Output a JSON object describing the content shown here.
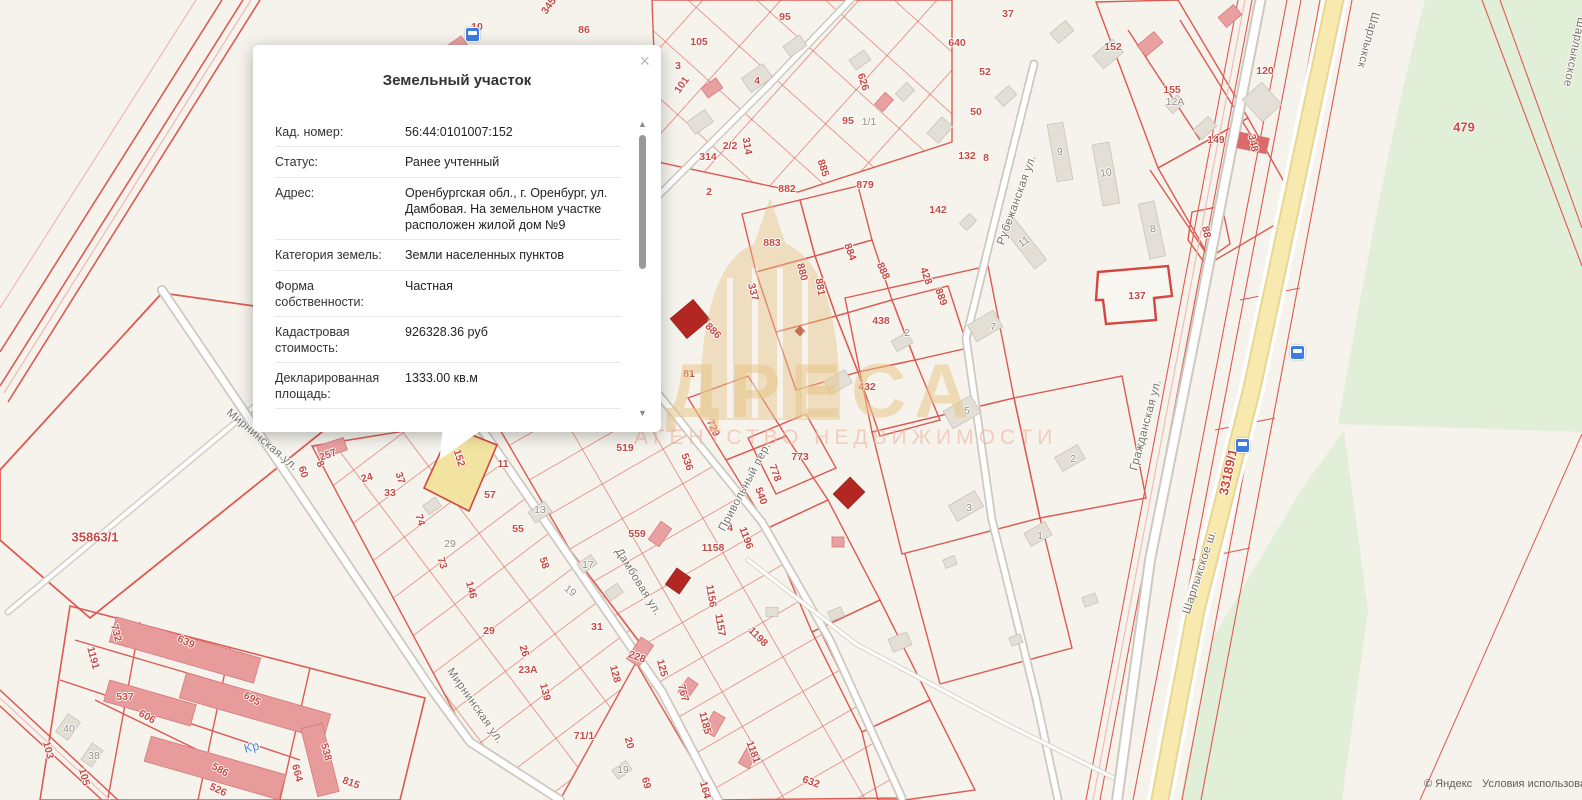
{
  "popup": {
    "title": "Земельный участок",
    "close_glyph": "×",
    "rows": [
      {
        "label": "Кад. номер:",
        "value": "56:44:0101007:152"
      },
      {
        "label": "Статус:",
        "value": "Ранее учтенный"
      },
      {
        "label": "Адрес:",
        "value": "Оренбургская обл., г. Оренбург, ул. Дамбовая. На земельном участке расположен жилой дом №9"
      },
      {
        "label": "Категория земель:",
        "value": "Земли населенных пунктов"
      },
      {
        "label": "Форма собственности:",
        "value": "Частная"
      },
      {
        "label": "Кадастровая стоимость:",
        "value": "926328.36 руб"
      },
      {
        "label": "Декларированная площадь:",
        "value": "1333.00 кв.м"
      }
    ],
    "scroll_up_glyph": "▲",
    "scroll_down_glyph": "▼"
  },
  "watermark": {
    "title": "АДРЕСА",
    "subtitle": "АГЕНТСТВО НЕДВИЖИМОСТИ"
  },
  "attribution": {
    "copyright": "© Яндекс",
    "terms": "Условия использования"
  },
  "colors": {
    "map_bg": "#f5f3ec",
    "parcel_line": "#dd5a52",
    "selected_fill": "#f2e3a0",
    "road_yellow": "#f8e9ae",
    "green_area": "#e2efd8",
    "bus_blue": "#3f7be0",
    "watermark_gold": "#e7c488",
    "dark_building": "#b32723",
    "pink_building": "#e9a0a0"
  },
  "map": {
    "selected_parcel": "152",
    "labels": [
      {
        "t": "345",
        "x": 549,
        "y": 6,
        "r": -55,
        "k": "parcel"
      },
      {
        "t": "86",
        "x": 584,
        "y": 30,
        "r": 0,
        "k": "parcel"
      },
      {
        "t": "10",
        "x": 477,
        "y": 27,
        "r": 0,
        "k": "parcel"
      },
      {
        "t": "105",
        "x": 699,
        "y": 42,
        "r": 0,
        "k": "parcel"
      },
      {
        "t": "3",
        "x": 678,
        "y": 66,
        "r": 0,
        "k": "parcel"
      },
      {
        "t": "101",
        "x": 682,
        "y": 85,
        "r": -55,
        "k": "parcel"
      },
      {
        "t": "4",
        "x": 757,
        "y": 81,
        "r": 0,
        "k": "parcel"
      },
      {
        "t": "95",
        "x": 785,
        "y": 17,
        "r": 0,
        "k": "parcel"
      },
      {
        "t": "626",
        "x": 863,
        "y": 82,
        "r": 72,
        "k": "parcel"
      },
      {
        "t": "640",
        "x": 957,
        "y": 43,
        "r": 0,
        "k": "parcel"
      },
      {
        "t": "37",
        "x": 1008,
        "y": 14,
        "r": 0,
        "k": "parcel"
      },
      {
        "t": "52",
        "x": 985,
        "y": 72,
        "r": 0,
        "k": "parcel"
      },
      {
        "t": "50",
        "x": 976,
        "y": 112,
        "r": 0,
        "k": "parcel"
      },
      {
        "t": "132",
        "x": 967,
        "y": 156,
        "r": 0,
        "k": "parcel"
      },
      {
        "t": "8",
        "x": 986,
        "y": 158,
        "r": 0,
        "k": "parcel"
      },
      {
        "t": "2/2",
        "x": 730,
        "y": 146,
        "r": 0,
        "k": "parcel"
      },
      {
        "t": "314",
        "x": 708,
        "y": 157,
        "r": 0,
        "k": "parcel"
      },
      {
        "t": "314",
        "x": 747,
        "y": 146,
        "r": 80,
        "k": "parcel"
      },
      {
        "t": "2",
        "x": 709,
        "y": 192,
        "r": 0,
        "k": "parcel"
      },
      {
        "t": "95",
        "x": 848,
        "y": 121,
        "r": 0,
        "k": "parcel"
      },
      {
        "t": "882",
        "x": 787,
        "y": 189,
        "r": 0,
        "k": "parcel"
      },
      {
        "t": "885",
        "x": 823,
        "y": 168,
        "r": 72,
        "k": "parcel"
      },
      {
        "t": "879",
        "x": 865,
        "y": 185,
        "r": 0,
        "k": "parcel"
      },
      {
        "t": "883",
        "x": 772,
        "y": 243,
        "r": 0,
        "k": "parcel"
      },
      {
        "t": "880",
        "x": 802,
        "y": 272,
        "r": 75,
        "k": "parcel"
      },
      {
        "t": "881",
        "x": 820,
        "y": 287,
        "r": 80,
        "k": "parcel"
      },
      {
        "t": "884",
        "x": 850,
        "y": 252,
        "r": 70,
        "k": "parcel"
      },
      {
        "t": "888",
        "x": 883,
        "y": 271,
        "r": 65,
        "k": "parcel"
      },
      {
        "t": "428",
        "x": 926,
        "y": 276,
        "r": 70,
        "k": "parcel"
      },
      {
        "t": "889",
        "x": 941,
        "y": 297,
        "r": 70,
        "k": "parcel"
      },
      {
        "t": "337",
        "x": 753,
        "y": 292,
        "r": 75,
        "k": "parcel"
      },
      {
        "t": "886",
        "x": 713,
        "y": 331,
        "r": 45,
        "k": "parcel"
      },
      {
        "t": "438",
        "x": 881,
        "y": 321,
        "r": 0,
        "k": "parcel"
      },
      {
        "t": "142",
        "x": 938,
        "y": 210,
        "r": 0,
        "k": "parcel"
      },
      {
        "t": "81",
        "x": 689,
        "y": 374,
        "r": 0,
        "k": "parcel"
      },
      {
        "t": "432",
        "x": 867,
        "y": 387,
        "r": 0,
        "k": "parcel"
      },
      {
        "t": "152",
        "x": 1113,
        "y": 47,
        "r": 0,
        "k": "parcel"
      },
      {
        "t": "155",
        "x": 1172,
        "y": 90,
        "r": 0,
        "k": "parcel"
      },
      {
        "t": "149",
        "x": 1216,
        "y": 140,
        "r": 0,
        "k": "parcel"
      },
      {
        "t": "120",
        "x": 1265,
        "y": 71,
        "r": 0,
        "k": "parcel"
      },
      {
        "t": "348",
        "x": 1253,
        "y": 143,
        "r": 78,
        "k": "parcel"
      },
      {
        "t": "88",
        "x": 1206,
        "y": 232,
        "r": 78,
        "k": "parcel"
      },
      {
        "t": "137",
        "x": 1137,
        "y": 296,
        "r": 0,
        "k": "parcel"
      },
      {
        "t": "60",
        "x": 303,
        "y": 472,
        "r": 72,
        "k": "parcel"
      },
      {
        "t": "257",
        "x": 328,
        "y": 455,
        "r": -20,
        "k": "parcel"
      },
      {
        "t": "24",
        "x": 367,
        "y": 478,
        "r": -15,
        "k": "parcel"
      },
      {
        "t": "33",
        "x": 390,
        "y": 493,
        "r": 0,
        "k": "parcel"
      },
      {
        "t": "37",
        "x": 400,
        "y": 478,
        "r": 72,
        "k": "parcel"
      },
      {
        "t": "74",
        "x": 420,
        "y": 520,
        "r": 72,
        "k": "parcel"
      },
      {
        "t": "73",
        "x": 442,
        "y": 563,
        "r": 72,
        "k": "parcel"
      },
      {
        "t": "146",
        "x": 471,
        "y": 590,
        "r": 75,
        "k": "parcel"
      },
      {
        "t": "29",
        "x": 489,
        "y": 631,
        "r": 0,
        "k": "parcel"
      },
      {
        "t": "26",
        "x": 524,
        "y": 651,
        "r": 72,
        "k": "parcel"
      },
      {
        "t": "23А",
        "x": 528,
        "y": 670,
        "r": 0,
        "k": "parcel"
      },
      {
        "t": "139",
        "x": 545,
        "y": 692,
        "r": 75,
        "k": "parcel"
      },
      {
        "t": "8",
        "x": 320,
        "y": 464,
        "r": 60,
        "k": "parcel"
      },
      {
        "t": "152",
        "x": 459,
        "y": 458,
        "r": 72,
        "k": "parcel"
      },
      {
        "t": "11",
        "x": 503,
        "y": 464,
        "r": 0,
        "k": "parcel"
      },
      {
        "t": "57",
        "x": 490,
        "y": 495,
        "r": 0,
        "k": "parcel"
      },
      {
        "t": "55",
        "x": 518,
        "y": 529,
        "r": 0,
        "k": "parcel"
      },
      {
        "t": "58",
        "x": 544,
        "y": 563,
        "r": 72,
        "k": "parcel"
      },
      {
        "t": "31",
        "x": 597,
        "y": 627,
        "r": 0,
        "k": "parcel"
      },
      {
        "t": "519",
        "x": 625,
        "y": 448,
        "r": 0,
        "k": "parcel"
      },
      {
        "t": "536",
        "x": 687,
        "y": 462,
        "r": 70,
        "k": "parcel"
      },
      {
        "t": "729",
        "x": 713,
        "y": 428,
        "r": 65,
        "k": "parcel"
      },
      {
        "t": "559",
        "x": 637,
        "y": 534,
        "r": 0,
        "k": "parcel"
      },
      {
        "t": "540",
        "x": 761,
        "y": 496,
        "r": 70,
        "k": "parcel"
      },
      {
        "t": "1196",
        "x": 746,
        "y": 538,
        "r": 70,
        "k": "parcel"
      },
      {
        "t": "1158",
        "x": 713,
        "y": 548,
        "r": 0,
        "k": "parcel"
      },
      {
        "t": "1156",
        "x": 711,
        "y": 596,
        "r": 80,
        "k": "parcel"
      },
      {
        "t": "1157",
        "x": 720,
        "y": 625,
        "r": 80,
        "k": "parcel"
      },
      {
        "t": "1198",
        "x": 758,
        "y": 637,
        "r": 45,
        "k": "parcel"
      },
      {
        "t": "778",
        "x": 775,
        "y": 473,
        "r": 70,
        "k": "parcel"
      },
      {
        "t": "773",
        "x": 800,
        "y": 457,
        "r": 0,
        "k": "parcel"
      },
      {
        "t": "228",
        "x": 637,
        "y": 657,
        "r": 20,
        "k": "parcel"
      },
      {
        "t": "128",
        "x": 615,
        "y": 674,
        "r": 75,
        "k": "parcel"
      },
      {
        "t": "125",
        "x": 662,
        "y": 668,
        "r": 75,
        "k": "parcel"
      },
      {
        "t": "767",
        "x": 683,
        "y": 693,
        "r": 75,
        "k": "parcel"
      },
      {
        "t": "71/1",
        "x": 584,
        "y": 736,
        "r": 0,
        "k": "parcel"
      },
      {
        "t": "20",
        "x": 629,
        "y": 743,
        "r": 75,
        "k": "parcel"
      },
      {
        "t": "69",
        "x": 646,
        "y": 783,
        "r": 75,
        "k": "parcel"
      },
      {
        "t": "1185",
        "x": 705,
        "y": 723,
        "r": 75,
        "k": "parcel"
      },
      {
        "t": "1181",
        "x": 753,
        "y": 752,
        "r": 70,
        "k": "parcel"
      },
      {
        "t": "164",
        "x": 705,
        "y": 790,
        "r": 75,
        "k": "parcel"
      },
      {
        "t": "632",
        "x": 811,
        "y": 782,
        "r": 20,
        "k": "parcel"
      },
      {
        "t": "4",
        "x": 730,
        "y": 528,
        "r": 0,
        "k": "parcel"
      },
      {
        "t": "1191",
        "x": 93,
        "y": 658,
        "r": 75,
        "k": "parcel"
      },
      {
        "t": "732",
        "x": 116,
        "y": 633,
        "r": 75,
        "k": "parcel"
      },
      {
        "t": "639",
        "x": 186,
        "y": 642,
        "r": 25,
        "k": "parcel"
      },
      {
        "t": "537",
        "x": 125,
        "y": 697,
        "r": 0,
        "k": "parcel"
      },
      {
        "t": "606",
        "x": 147,
        "y": 717,
        "r": 30,
        "k": "parcel"
      },
      {
        "t": "695",
        "x": 252,
        "y": 699,
        "r": 30,
        "k": "parcel"
      },
      {
        "t": "103",
        "x": 48,
        "y": 750,
        "r": 75,
        "k": "parcel"
      },
      {
        "t": "105",
        "x": 84,
        "y": 777,
        "r": 75,
        "k": "parcel"
      },
      {
        "t": "586",
        "x": 220,
        "y": 770,
        "r": 30,
        "k": "parcel"
      },
      {
        "t": "538",
        "x": 326,
        "y": 752,
        "r": 75,
        "k": "parcel"
      },
      {
        "t": "815",
        "x": 351,
        "y": 783,
        "r": 20,
        "k": "parcel"
      },
      {
        "t": "664",
        "x": 297,
        "y": 773,
        "r": 75,
        "k": "parcel"
      },
      {
        "t": "526",
        "x": 218,
        "y": 790,
        "r": 25,
        "k": "parcel"
      },
      {
        "t": "479",
        "x": 1464,
        "y": 127,
        "r": 0,
        "k": "parcel-big"
      },
      {
        "t": "33189/1",
        "x": 1228,
        "y": 472,
        "r": -78,
        "k": "parcel-big"
      },
      {
        "t": "35863/1",
        "x": 95,
        "y": 537,
        "r": 0,
        "k": "parcel-big"
      },
      {
        "t": "1/1",
        "x": 869,
        "y": 122,
        "r": 0,
        "k": "house"
      },
      {
        "t": "2",
        "x": 907,
        "y": 333,
        "r": 0,
        "k": "house"
      },
      {
        "t": "9",
        "x": 1060,
        "y": 152,
        "r": -8,
        "k": "house"
      },
      {
        "t": "10",
        "x": 1106,
        "y": 173,
        "r": -8,
        "k": "house"
      },
      {
        "t": "8",
        "x": 1153,
        "y": 229,
        "r": -10,
        "k": "house"
      },
      {
        "t": "11",
        "x": 1024,
        "y": 242,
        "r": -35,
        "k": "house"
      },
      {
        "t": "12А",
        "x": 1175,
        "y": 102,
        "r": 0,
        "k": "house"
      },
      {
        "t": "7",
        "x": 993,
        "y": 327,
        "r": 0,
        "k": "house"
      },
      {
        "t": "5",
        "x": 967,
        "y": 411,
        "r": 0,
        "k": "house"
      },
      {
        "t": "2",
        "x": 1073,
        "y": 459,
        "r": 0,
        "k": "house"
      },
      {
        "t": "3",
        "x": 969,
        "y": 508,
        "r": 0,
        "k": "house"
      },
      {
        "t": "1",
        "x": 1040,
        "y": 536,
        "r": 0,
        "k": "house"
      },
      {
        "t": "13",
        "x": 540,
        "y": 510,
        "r": 0,
        "k": "house"
      },
      {
        "t": "17",
        "x": 588,
        "y": 565,
        "r": 0,
        "k": "house"
      },
      {
        "t": "19",
        "x": 570,
        "y": 591,
        "r": 40,
        "k": "house"
      },
      {
        "t": "19",
        "x": 623,
        "y": 770,
        "r": 0,
        "k": "house"
      },
      {
        "t": "29",
        "x": 450,
        "y": 544,
        "r": 0,
        "k": "house"
      },
      {
        "t": "40",
        "x": 69,
        "y": 729,
        "r": 0,
        "k": "house"
      },
      {
        "t": "38",
        "x": 94,
        "y": 756,
        "r": 0,
        "k": "house"
      },
      {
        "t": "Мирнинская ул.",
        "x": 262,
        "y": 440,
        "r": 40,
        "k": "street"
      },
      {
        "t": "Мирнинская ул.",
        "x": 475,
        "y": 706,
        "r": 55,
        "k": "street"
      },
      {
        "t": "Дамбовая ул.",
        "x": 638,
        "y": 582,
        "r": 58,
        "k": "street"
      },
      {
        "t": "Привольный пер.",
        "x": 745,
        "y": 487,
        "r": -62,
        "k": "street"
      },
      {
        "t": "Гражданская ул.",
        "x": 1146,
        "y": 425,
        "r": -75,
        "k": "street"
      },
      {
        "t": "Рубежанская ул.",
        "x": 1017,
        "y": 200,
        "r": -70,
        "k": "street"
      },
      {
        "t": "Шарлыкское ш.",
        "x": 1200,
        "y": 572,
        "r": -72,
        "k": "street"
      },
      {
        "t": "Шарлыкск",
        "x": 1368,
        "y": 40,
        "r": 105,
        "k": "street"
      },
      {
        "t": "Шарлыкское",
        "x": 1574,
        "y": 52,
        "r": 102,
        "k": "street"
      },
      {
        "t": "Кр",
        "x": 252,
        "y": 747,
        "r": -15,
        "k": "water"
      }
    ],
    "icons": [
      {
        "name": "bus-stop-icon",
        "x": 472,
        "y": 34
      },
      {
        "name": "bus-stop-icon",
        "x": 1242,
        "y": 445
      },
      {
        "name": "bus-stop-icon",
        "x": 1297,
        "y": 352
      }
    ]
  }
}
